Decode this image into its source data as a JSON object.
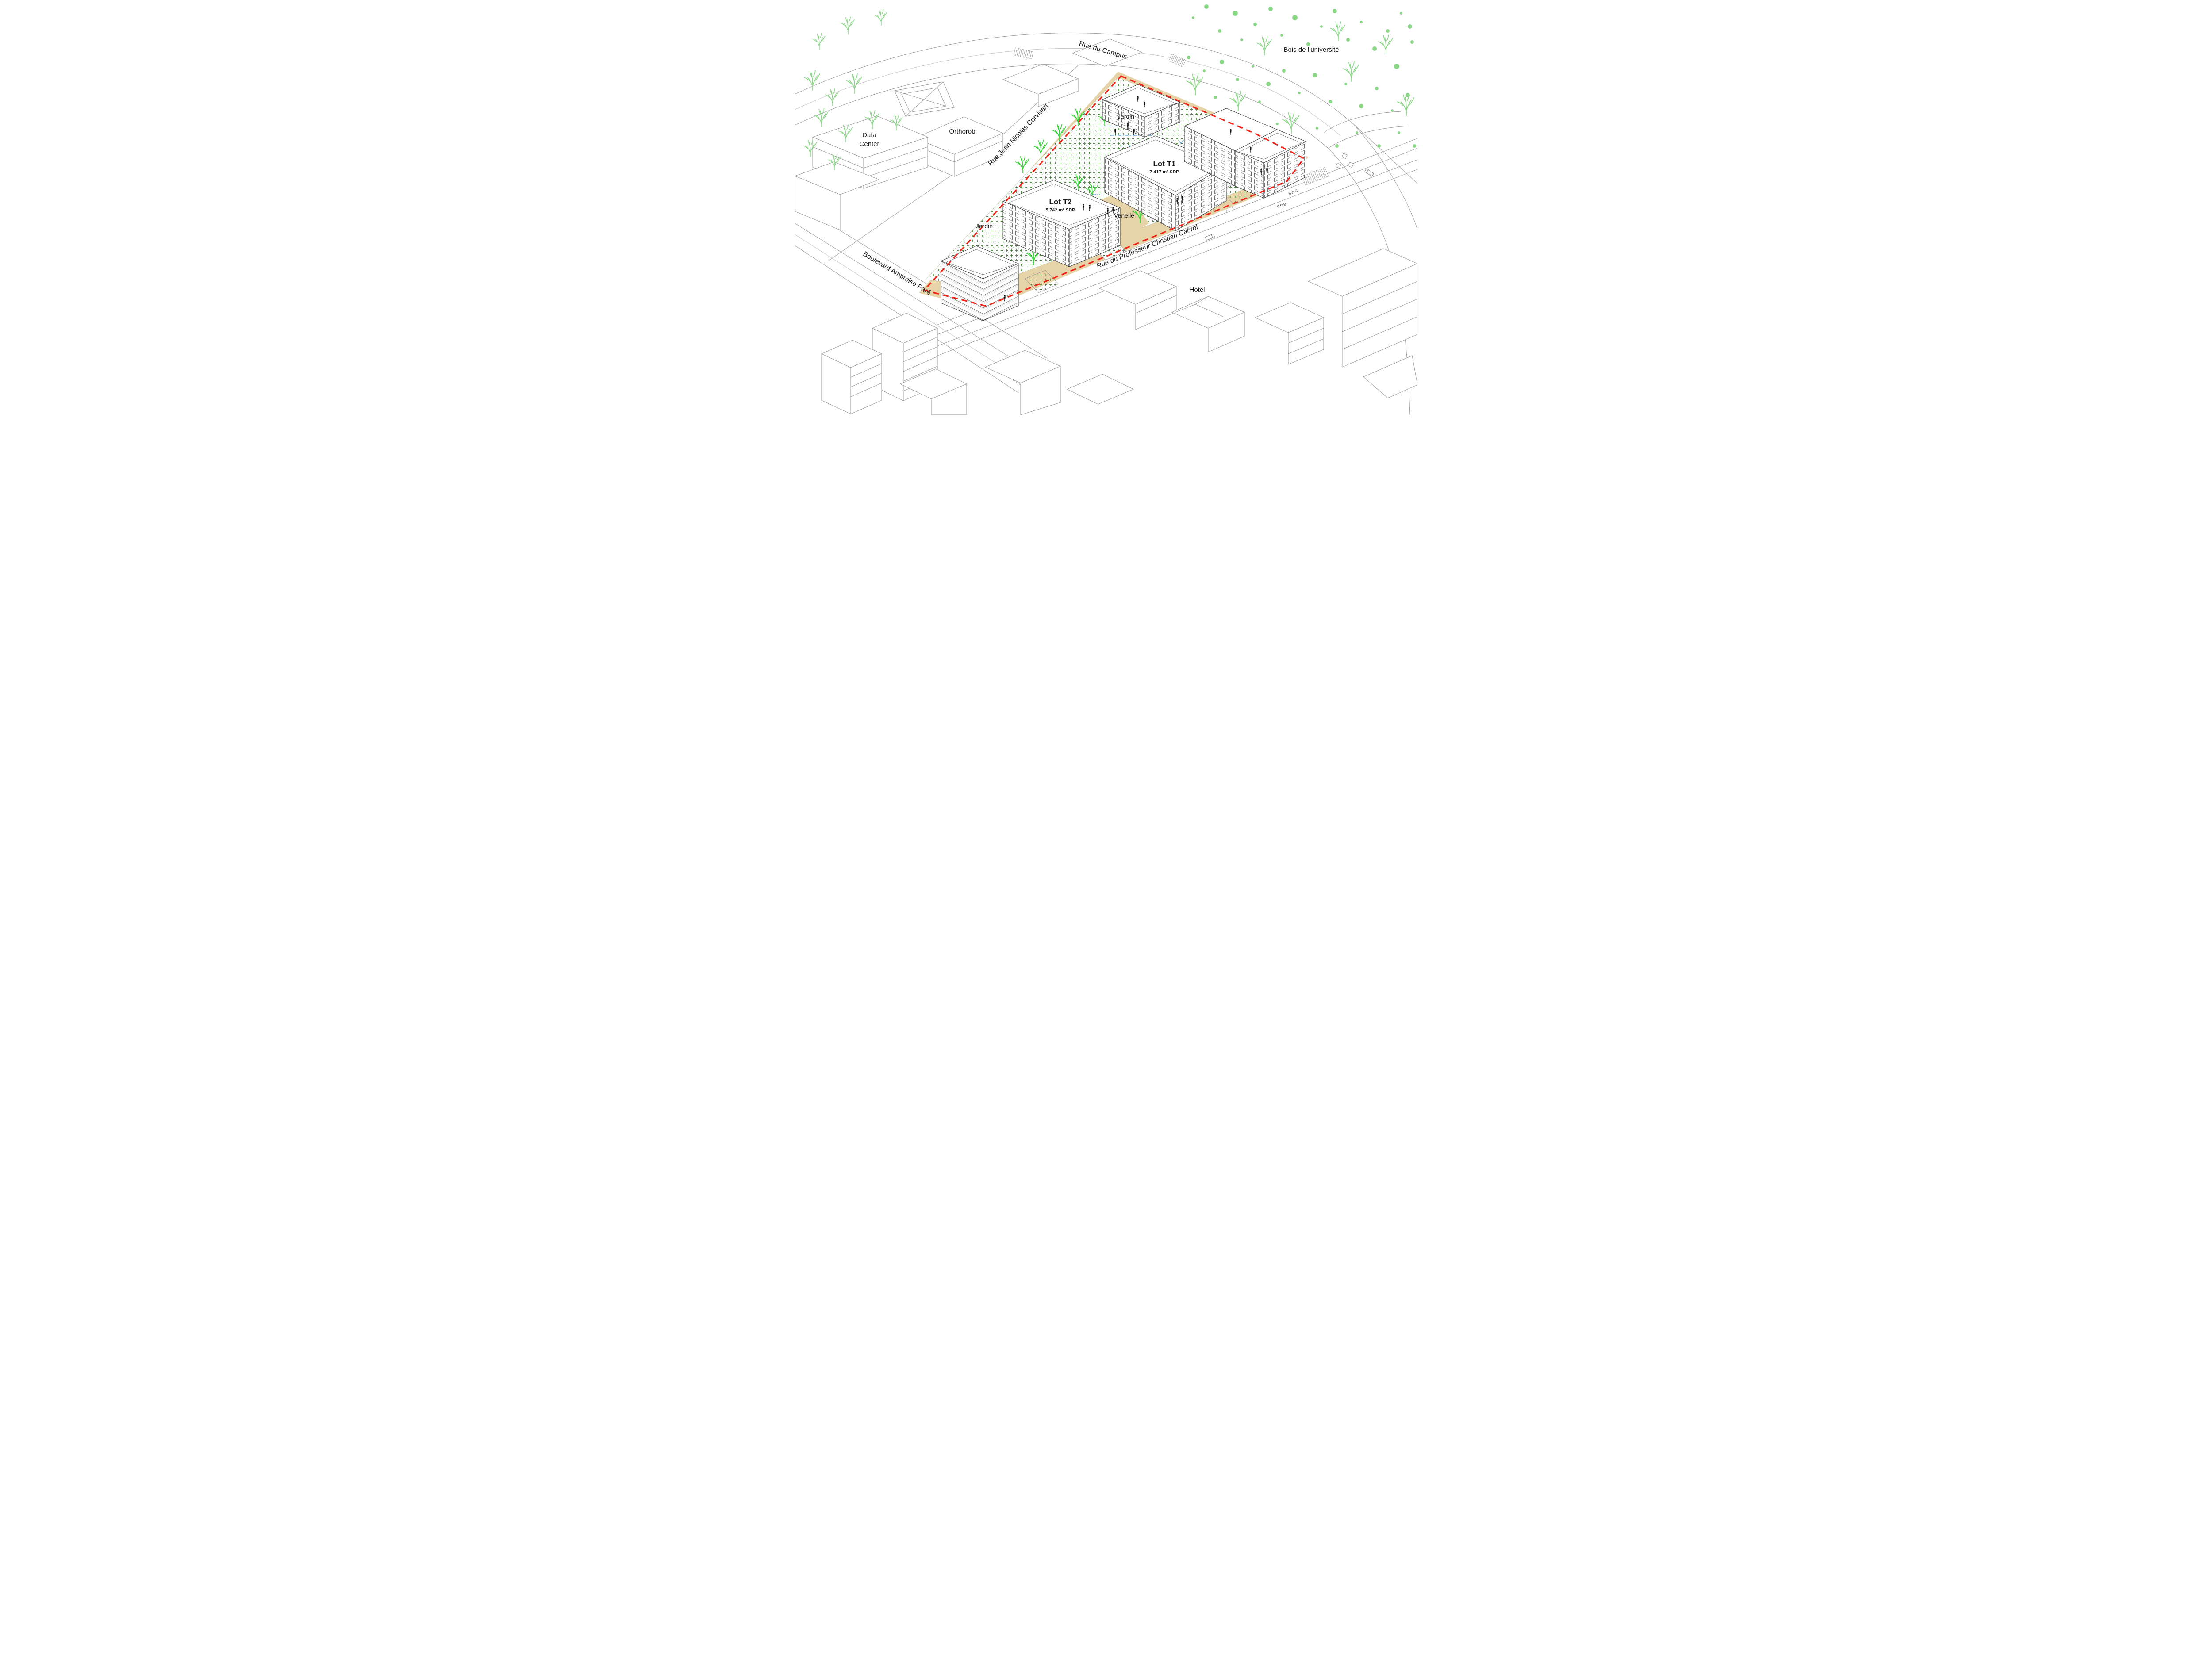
{
  "palette": {
    "site_tan": "#e6d3a8",
    "boundary_red": "#ee2418",
    "lot_pink": "#f0136b",
    "tree_green": "#2fd32f",
    "foliage_light_green": "#8bd687",
    "garden_cross_green": "#4e8f3e",
    "water_blue": "#58a0e0",
    "context_line_gray": "#9a9a9a",
    "building_line": "#3c3c3c"
  },
  "labels": {
    "streets": {
      "campus": "Rue du Campus",
      "corvisart": "Rue Jean Nicolas Corvisart",
      "cabrol": "Rue du Professeur Christian Cabrol",
      "pare": "Boulevard Ambroise Paré"
    },
    "places": {
      "bois": "Bois de l’université",
      "orthorob": "Orthorob",
      "data_center": [
        "Data",
        "Center"
      ],
      "hotel": "Hotel"
    },
    "site": {
      "jardin_north": "Jardin",
      "jardin_west": "Jardin",
      "venelle": "Venelle"
    },
    "lots": [
      {
        "name": "Lot T1",
        "area": "7 417 m² SDP"
      },
      {
        "name": "Lot T2",
        "area": "5 742 m² SDP"
      }
    ],
    "road_markings": {
      "bus": "BUS"
    }
  }
}
